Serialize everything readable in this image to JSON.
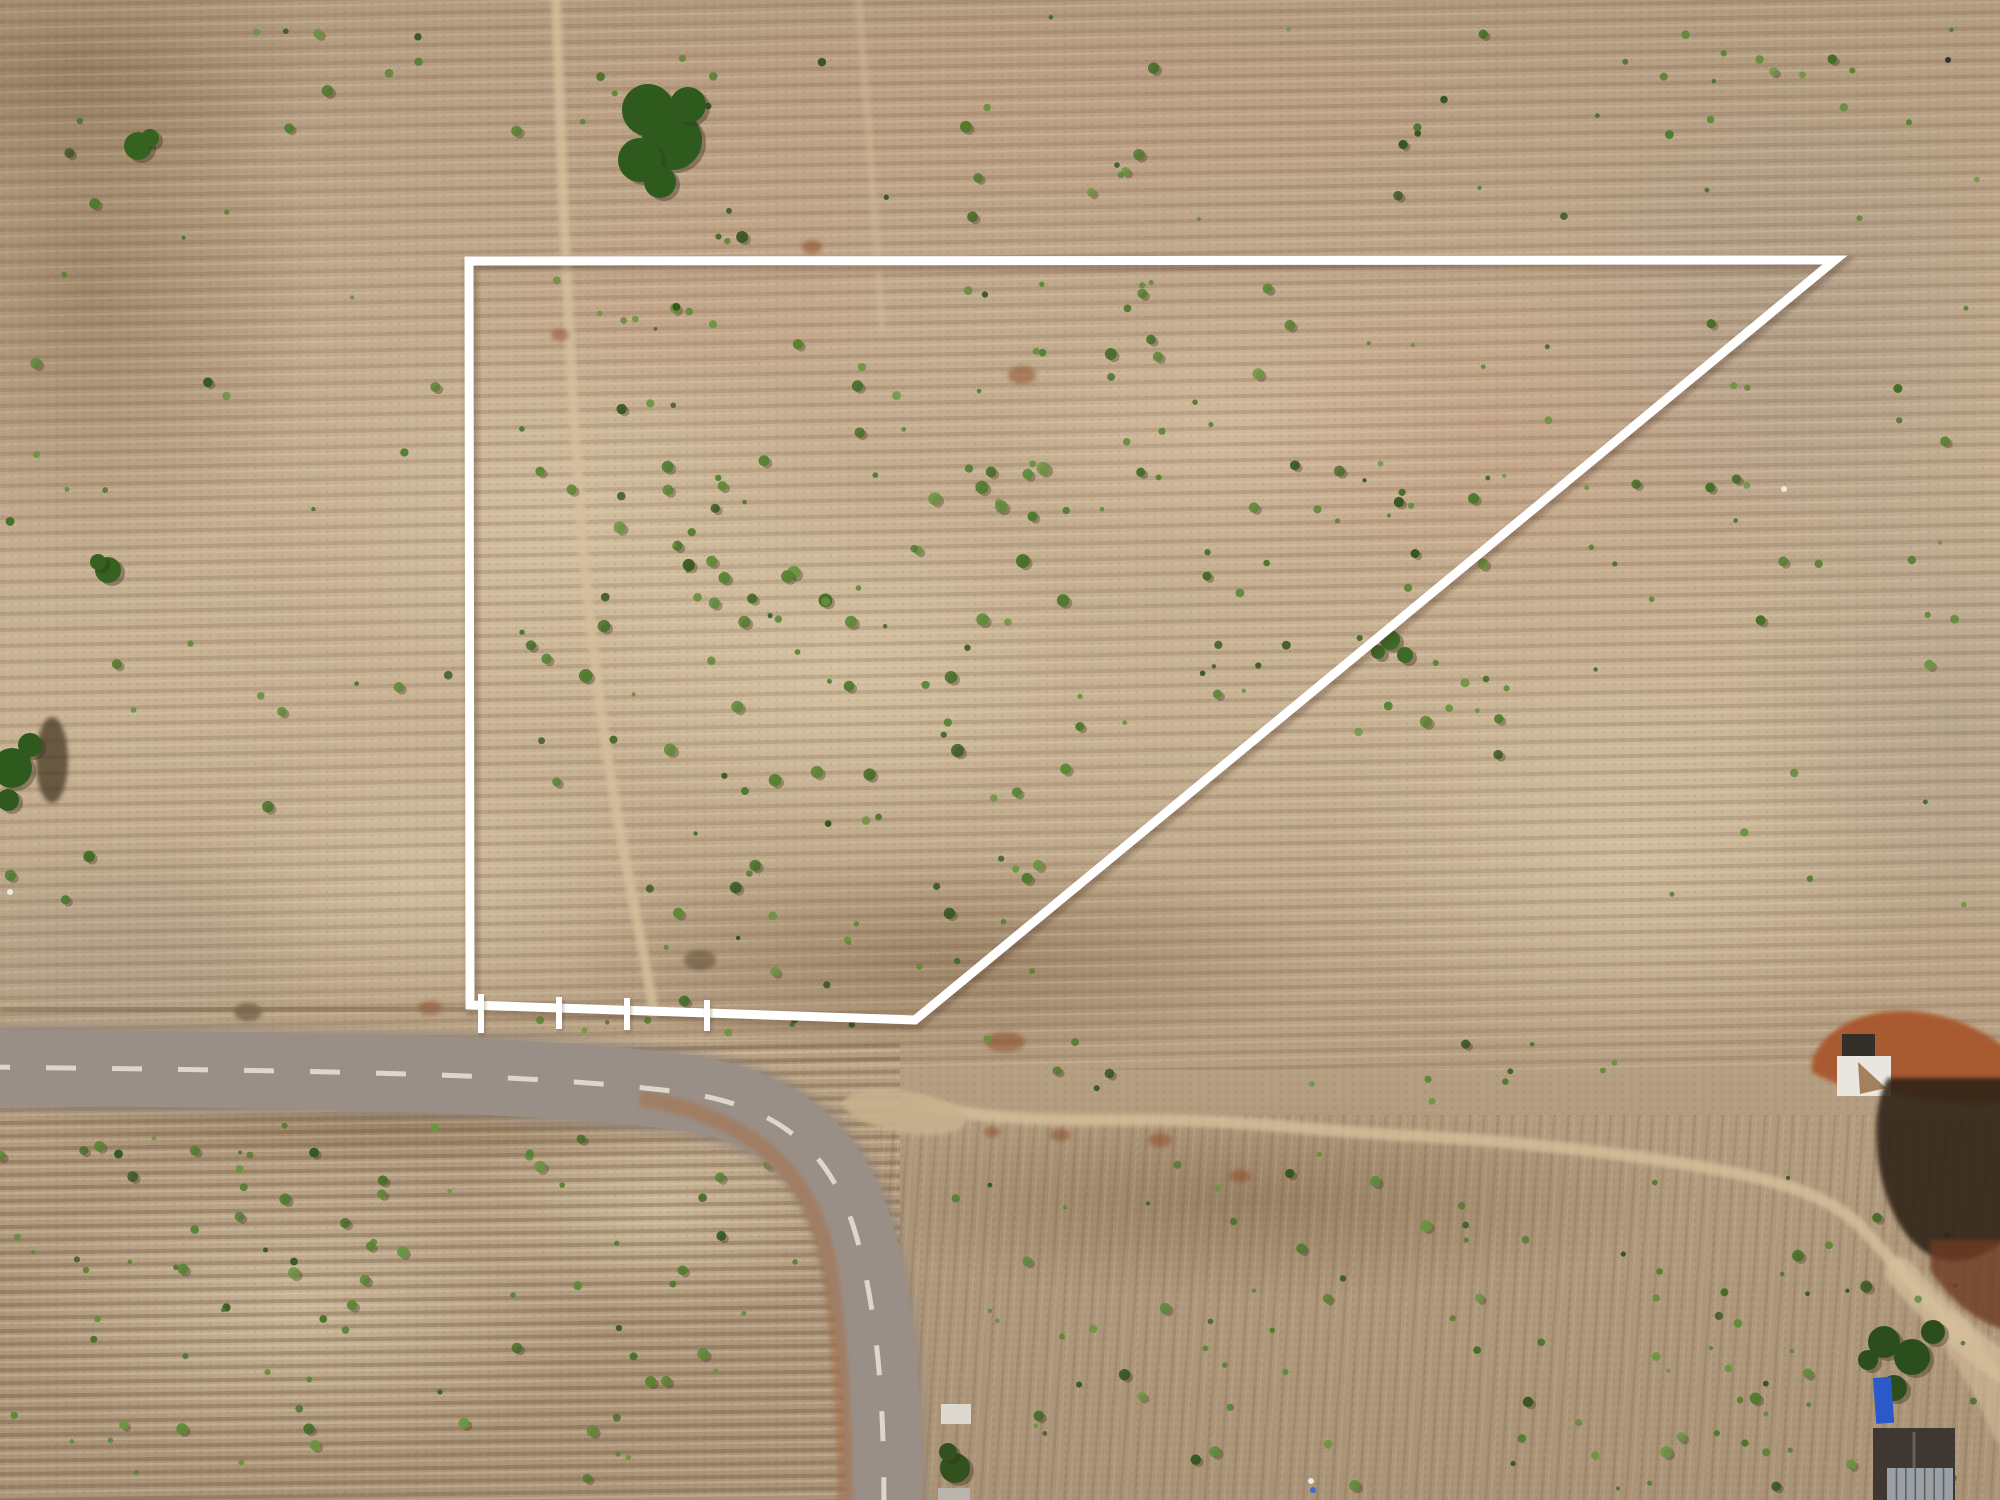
{
  "scene": {
    "width": 2000,
    "height": 1500,
    "palette": {
      "grass_top": "#b29b7f",
      "grass_upper": "#c2ab8e",
      "grass_mid": "#c8b294",
      "grass_lower": "#b29b7e",
      "grass_bottom": "#aa9377",
      "row_dark": "rgba(108,84,58,0.22)",
      "row_light": "rgba(242,228,202,0.16)",
      "bush_greens": [
        "#4f7a2d",
        "#5d8938",
        "#446d27",
        "#6a9440",
        "#35571f",
        "#578231"
      ],
      "bush_shadow": "#4a3a26",
      "trail": "#d6c09c",
      "road_asphalt": "#9a8f86",
      "road_under": "#8f857c",
      "road_dash": "#e3ddcf",
      "road_rust": "#a86a3c",
      "shoulder_dark": "#7e6950",
      "junction_dirt": "#c8b18d",
      "boundary_white": "#ffffff",
      "boundary_shadow": "rgba(70,50,30,0.30)",
      "red_dirt": "#a8552b",
      "burnt_dark": "#2e2119",
      "burnt_rust": "#6e3a20",
      "pad_white": "#e9e6df",
      "pit_dark": "#33302a",
      "notch_tan": "#a3815f",
      "building_roof": "#3f3731",
      "roof_ridge": "#6b5f55",
      "panel_grey": "#9aa0a4",
      "panel_line": "#5a5e62",
      "tarp_blue": "#2b59c9",
      "shed_white": "#ded9ce",
      "shed_grey": "#b9b4ac",
      "tree_dark": "#2e5a1d",
      "tree_darker": "#2c4e1d",
      "rust_spot": "#8a4a26"
    },
    "boundary": {
      "label": "surveyed land plot outline",
      "points": "469,261 1835,260 915,1020 470,1005",
      "stroke_width": 9,
      "pegs": [
        {
          "x": 481,
          "y1": 994,
          "y2": 1033
        },
        {
          "x": 559,
          "y1": 997,
          "y2": 1029
        },
        {
          "x": 627,
          "y1": 998,
          "y2": 1030
        },
        {
          "x": 707,
          "y1": 1000,
          "y2": 1031
        }
      ]
    },
    "road": {
      "label": "asphalt road curving from left edge to bottom edge",
      "center": "M-12,1067 C300,1071 520,1072 680,1092 C790,1107 838,1160 860,1250 C878,1325 884,1400 884,1512",
      "width": 76,
      "dash_pattern": "30 36",
      "dash_width": 5,
      "shoulder_dark": "M0,1008 L468,1011",
      "inner_rust": "M640,1098 C760,1118 812,1180 828,1260 C840,1330 844,1420 845,1500",
      "junction": {
        "cx": 905,
        "cy": 1112,
        "rx": 62,
        "ry": 21,
        "rot": 9
      }
    },
    "trails": [
      {
        "name": "footpath-inside-plot",
        "d": "M556,-5 C560,120 566,300 578,480 C586,600 600,720 618,820 C632,900 646,960 654,1014",
        "w": 10,
        "o": 0.8
      },
      {
        "name": "faint-path-top-center",
        "d": "M858,-5 C866,90 874,200 882,330",
        "w": 8,
        "o": 0.4
      },
      {
        "name": "dirt-track-east",
        "d": "M918,1102 C980,1122 1060,1120 1150,1120 C1250,1120 1320,1132 1420,1136 C1520,1142 1620,1152 1720,1170 C1790,1183 1835,1200 1862,1228 C1890,1258 1925,1300 1965,1338",
        "w": 12,
        "o": 0.8
      },
      {
        "name": "dirt-track-widening",
        "d": "M1900,1272 C1935,1312 1968,1345 2010,1372",
        "w": 30,
        "o": 0.7
      },
      {
        "name": "dirt-track-corner",
        "d": "M1952,1330 C1975,1360 1995,1395 2008,1428",
        "w": 34,
        "o": 0.55
      }
    ],
    "tonal_patches": [
      {
        "cx": 560,
        "cy": 520,
        "rx": 300,
        "ry": 210,
        "g": "pale"
      },
      {
        "cx": 830,
        "cy": 660,
        "rx": 260,
        "ry": 170,
        "g": "pale"
      },
      {
        "cx": 420,
        "cy": 880,
        "rx": 240,
        "ry": 150,
        "g": "pale"
      },
      {
        "cx": 1620,
        "cy": 860,
        "rx": 300,
        "ry": 210,
        "g": "pale"
      },
      {
        "cx": 300,
        "cy": 1310,
        "rx": 290,
        "ry": 160,
        "g": "pale"
      },
      {
        "cx": 660,
        "cy": 1210,
        "rx": 200,
        "ry": 110,
        "g": "pale"
      },
      {
        "cx": 1240,
        "cy": 430,
        "rx": 240,
        "ry": 130,
        "g": "pale"
      },
      {
        "cx": 1000,
        "cy": 110,
        "rx": 760,
        "ry": 150,
        "g": "pink"
      },
      {
        "cx": 1480,
        "cy": 430,
        "rx": 430,
        "ry": 230,
        "g": "pink"
      },
      {
        "cx": 700,
        "cy": 300,
        "rx": 300,
        "ry": 130,
        "g": "pink"
      },
      {
        "cx": 90,
        "cy": 290,
        "rx": 230,
        "ry": 290,
        "g": "dark"
      },
      {
        "cx": 70,
        "cy": 70,
        "rx": 260,
        "ry": 130,
        "g": "dark"
      },
      {
        "cx": 950,
        "cy": 960,
        "rx": 380,
        "ry": 110,
        "g": "dark"
      },
      {
        "cx": 1250,
        "cy": 1200,
        "rx": 430,
        "ry": 100,
        "g": "dark"
      },
      {
        "cx": 400,
        "cy": 1125,
        "rx": 420,
        "ry": 40,
        "g": "dark"
      },
      {
        "cx": 1790,
        "cy": 330,
        "rx": 270,
        "ry": 300,
        "g": "grey"
      },
      {
        "cx": 1950,
        "cy": 720,
        "rx": 220,
        "ry": 260,
        "g": "grey"
      },
      {
        "cx": 120,
        "cy": 950,
        "rx": 200,
        "ry": 120,
        "g": "grey"
      }
    ],
    "veg_seed": 1337,
    "veg_regions": [
      [
        500,
        275,
        950,
        175,
        40,
        2,
        6
      ],
      [
        520,
        455,
        560,
        340,
        80,
        2,
        7
      ],
      [
        1090,
        460,
        420,
        270,
        38,
        2,
        6
      ],
      [
        620,
        790,
        430,
        215,
        30,
        2,
        6
      ],
      [
        1350,
        300,
        620,
        650,
        42,
        2,
        5
      ],
      [
        250,
        15,
        1260,
        230,
        42,
        2,
        6
      ],
      [
        1560,
        20,
        430,
        230,
        20,
        2,
        5
      ],
      [
        10,
        120,
        440,
        830,
        30,
        2,
        6
      ],
      [
        480,
        1016,
        380,
        20,
        8,
        2,
        4
      ],
      [
        960,
        1035,
        660,
        70,
        14,
        2,
        5
      ],
      [
        0,
        1120,
        830,
        370,
        85,
        2,
        6
      ],
      [
        940,
        1150,
        1040,
        340,
        80,
        2,
        6
      ],
      [
        1700,
        1260,
        280,
        230,
        18,
        2,
        5
      ]
    ],
    "tree_clumps": [
      {
        "name": "tree-clump-top-center",
        "color": "#2e5a1d",
        "dots": [
          [
            648,
            110,
            26
          ],
          [
            672,
            140,
            30
          ],
          [
            640,
            160,
            22
          ],
          [
            688,
            105,
            18
          ],
          [
            660,
            182,
            16
          ]
        ]
      },
      {
        "name": "tree-small-upper-left",
        "color": "#35631f",
        "dots": [
          [
            138,
            146,
            14
          ],
          [
            150,
            138,
            9
          ]
        ]
      },
      {
        "name": "tree-small-left",
        "color": "#35631f",
        "dots": [
          [
            108,
            570,
            13
          ],
          [
            98,
            562,
            8
          ]
        ]
      },
      {
        "name": "tree-left-edge",
        "color": "#2e5a1d",
        "dots": [
          [
            12,
            768,
            20
          ],
          [
            30,
            745,
            12
          ],
          [
            8,
            800,
            11
          ]
        ]
      },
      {
        "name": "tree-cluster-bottom-right",
        "color": "#2c4e1d",
        "dots": [
          [
            1884,
            1342,
            16
          ],
          [
            1912,
            1357,
            18
          ],
          [
            1894,
            1388,
            13
          ],
          [
            1933,
            1332,
            12
          ],
          [
            1868,
            1360,
            10
          ]
        ]
      },
      {
        "name": "bush-cluster-mid-right",
        "color": "#3c6b26",
        "dots": [
          [
            1390,
            640,
            10
          ],
          [
            1405,
            655,
            8
          ],
          [
            1378,
            652,
            7
          ]
        ]
      },
      {
        "name": "bush-cluster-near-shed",
        "color": "#33511f",
        "dots": [
          [
            955,
            1468,
            15
          ],
          [
            948,
            1452,
            9
          ]
        ]
      }
    ],
    "shadow_blobs": [
      {
        "cx": 52,
        "cy": 760,
        "rx": 16,
        "ry": 43,
        "o": 0.75
      },
      {
        "cx": 248,
        "cy": 1012,
        "rx": 14,
        "ry": 9,
        "o": 0.5
      },
      {
        "cx": 700,
        "cy": 960,
        "rx": 16,
        "ry": 10,
        "o": 0.45
      }
    ],
    "rust_spots": [
      [
        1022,
        375,
        14,
        9
      ],
      [
        812,
        247,
        10,
        7
      ],
      [
        560,
        335,
        9,
        6
      ],
      [
        1005,
        1042,
        20,
        10
      ],
      [
        1160,
        1140,
        12,
        7
      ],
      [
        1060,
        1135,
        10,
        6
      ],
      [
        992,
        1132,
        8,
        5
      ],
      [
        1240,
        1176,
        11,
        6
      ],
      [
        430,
        1008,
        12,
        7
      ]
    ],
    "structures": {
      "red_mound": {
        "label": "red excavated dirt mound",
        "d": "M1812,1062 C1820,1035 1848,1018 1882,1012 C1925,1006 1968,1022 1995,1040 L2006,1048 L2006,1102 C1970,1108 1930,1100 1890,1094 C1855,1090 1828,1082 1812,1072 Z"
      },
      "dark_pit": {
        "x": 1842,
        "y": 1034,
        "w": 33,
        "h": 24
      },
      "white_pad": {
        "x": 1837,
        "y": 1056,
        "w": 54,
        "h": 40
      },
      "pad_notch": "1858,1062 1886,1088 1860,1094",
      "burnt_area": {
        "label": "burned black field patch",
        "d": "M1888,1078 L2006,1078 L2006,1240 C1975,1262 1950,1268 1925,1252 C1900,1236 1884,1200 1878,1160 C1874,1120 1878,1095 1888,1078 Z"
      },
      "burnt_lower": {
        "d": "M1930,1240 L2006,1240 L2006,1330 C1975,1322 1950,1300 1930,1270 Z"
      },
      "shed_white": {
        "x": 941,
        "y": 1404,
        "w": 30,
        "h": 20
      },
      "shed_grey": {
        "x": 938,
        "y": 1488,
        "w": 32,
        "h": 12
      },
      "building": {
        "label": "house with dark gable roof",
        "x": 1873,
        "y": 1428,
        "w": 82,
        "h": 74
      },
      "panels": {
        "x": 1887,
        "y": 1468,
        "w": 66,
        "h": 32,
        "lines": 6
      },
      "tarp": {
        "label": "blue tarp",
        "x": 1873,
        "y": 1378,
        "w": 18,
        "h": 46
      }
    },
    "specks": [
      {
        "x": 10,
        "y": 892,
        "r": 3,
        "c": "#f0ece2"
      },
      {
        "x": 1784,
        "y": 489,
        "r": 3,
        "c": "#eeeae0"
      },
      {
        "x": 1311,
        "y": 1481,
        "r": 3,
        "c": "#e8e8e8"
      },
      {
        "x": 1313,
        "y": 1490,
        "r": 3,
        "c": "#3b6bd6"
      },
      {
        "x": 1948,
        "y": 60,
        "r": 3,
        "c": "#3a342c"
      }
    ]
  }
}
